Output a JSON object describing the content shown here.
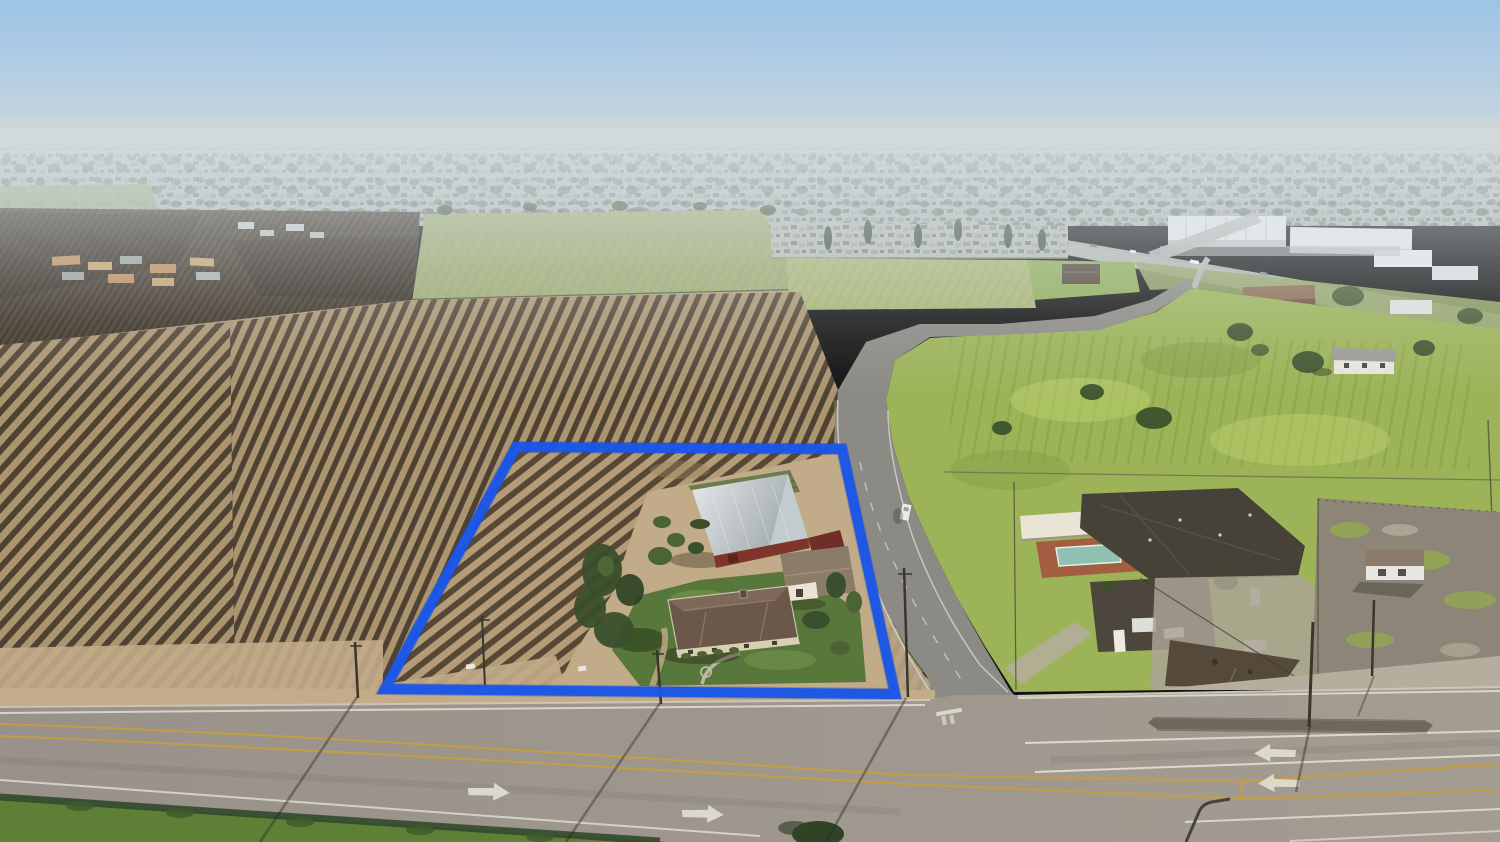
{
  "scene": {
    "type": "aerial-drone-real-estate-photo",
    "description": "Hazy morning aerial photo of a rural farm parcel outlined in blue: dormant vineyard rows, a red barn with a silver roof, an outbuilding and a hip-roof farmhouse with green lawn. A two-lane country road runs along the east side and meets a wide multi-lane highway across the bottom. Right of the road are a neighboring compound with a swimming pool and dark roofs, green pastures and a dirt lot. The horizon holds a hazy suburb, a mobile-home park, white industrial warehouses and a distant freeway.",
    "property_outline": {
      "shape": "quadrilateral",
      "points": "516,447 842,449 895,694 385,689",
      "stroke_width": 10,
      "color": "#1b57e8"
    }
  },
  "colors": {
    "sky_top": "#9cc4e6",
    "sky_mid": "#c2d3e0",
    "sky_horizon": "#dde4e8",
    "haze": "#d6dee2",
    "city_base": "#b2bab6",
    "city_tree": "#5a6c5c",
    "orange_roof": "#bf8a58",
    "warehouse_white": "#e9edec",
    "warehouse_shade": "#c2cac9",
    "distant_road": "#bfc3bf",
    "orchard_base": "#45382a",
    "orchard_row": "#332a1f",
    "field_green": "#9fab6d",
    "field2_green": "#aab873",
    "bright_green": "#8fae56",
    "vineyard_base": "#ab9570",
    "vineyard_row": "#4f4232",
    "prop_vineyard_base": "#b39c77",
    "prop_vineyard_row": "#564835",
    "dirt": "#c2ab88",
    "dirt_dark": "#99805f",
    "pasture": "#9cb457",
    "pasture_light": "#c2d473",
    "pasture_dark": "#7c9a44",
    "lawn": "#57783a",
    "tree_dark": "#3a4f2c",
    "tree_mid": "#4c6334",
    "road_asphalt": "#8b8a84",
    "road_edge_white": "#dcdad2",
    "highway": "#99928a",
    "highway_light": "#a39c91",
    "lane_white": "#e3dfd3",
    "lane_yellow": "#c79f3e",
    "median": "#6e675c",
    "shoulder": "#c3ac8a",
    "curb": "#d6d0c0",
    "sidewalk": "#b5ae9e",
    "barn_roof_light": "#e5e8e9",
    "barn_roof_dark": "#9fa8ab",
    "barn_red": "#7e352a",
    "barn_red_dark": "#6f2f26",
    "outbuilding_roof": "#8b7c6a",
    "wall_white": "#e9e4d6",
    "house_roof": "#6b5848",
    "house_roof_light": "#7d685a",
    "house_wall": "#d9cfb2",
    "pool_water": "#8fc0b2",
    "pool_deck": "#a35a40",
    "neighbor_roof": "#474238",
    "neighbor_roof2": "#4d463c",
    "concrete": "#aaa394",
    "dirt_lot": "#8d8577",
    "grass_verge": "#5d8036",
    "hedge": "#31482a",
    "vehicle_white": "#eceae4",
    "pole": "#3a362c",
    "outline_blue": "#1b57e8"
  },
  "road_markings": {
    "right_merge_arrows": 2,
    "left_lane_arrows": 2,
    "center_line_color": "#c79f3e",
    "lane_line_color": "#e3dfd3",
    "two_way_left_turn_lane": true,
    "stop_bar_on_side_road": true
  },
  "objects": {
    "vehicles_near_roads": 7,
    "distant_freeway_vehicles": 7,
    "buildings_on_property": [
      "barn",
      "outbuilding",
      "farmhouse"
    ],
    "neighbor_has_pool": true,
    "utility_poles_with_shadows": 5
  }
}
